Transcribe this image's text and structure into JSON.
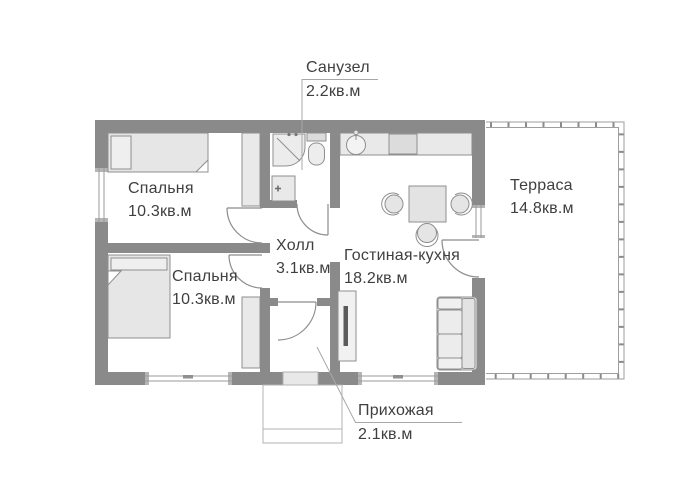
{
  "plan": {
    "rooms": [
      {
        "key": "bedroom-top",
        "name": "Спальня",
        "area": "10.3кв.м"
      },
      {
        "key": "bedroom-bottom",
        "name": "Спальня",
        "area": "10.3кв.м"
      },
      {
        "key": "hall",
        "name": "Холл",
        "area": "3.1кв.м"
      },
      {
        "key": "living-kitchen",
        "name": "Гостиная-кухня",
        "area": "18.2кв.м"
      },
      {
        "key": "terrace",
        "name": "Терраса",
        "area": "14.8кв.м"
      },
      {
        "key": "bathroom",
        "name": "Санузел",
        "area": "2.2кв.м"
      },
      {
        "key": "entry",
        "name": "Прихожая",
        "area": "2.1кв.м"
      }
    ],
    "colors": {
      "wall": "#8a8a8a",
      "furniture_fill": "#e9e9e9",
      "outline": "#8f8f8f",
      "text": "#3f3f3f",
      "leader": "#a8a8a8",
      "window_line": "#9a9a9a"
    }
  }
}
